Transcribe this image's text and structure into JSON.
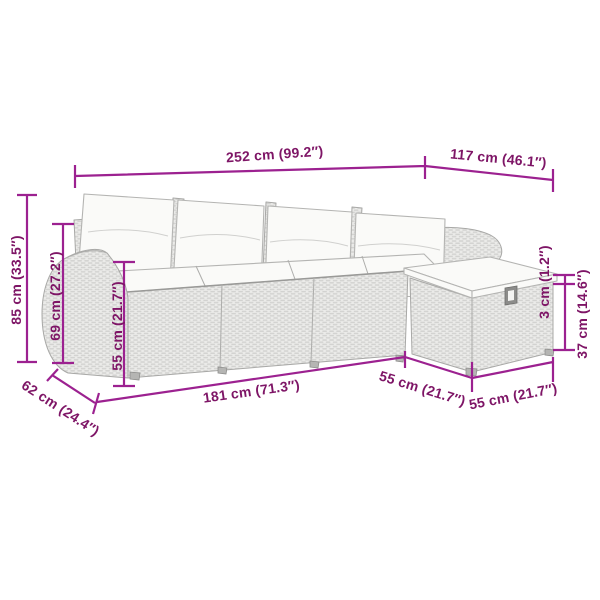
{
  "illustration": {
    "alt": "Light gray poly rattan garden sofa set with white cushions: four-seat sofa with armrests and an angled footstool module, annotated with dimension lines"
  },
  "colors": {
    "background": "#ffffff",
    "dimension_line": "#9c2190",
    "dimension_text": "#7e1566",
    "furniture_outline": "#a8a8a6",
    "wicker_fill": "#ebebe9",
    "wicker_weave": "#d2d2d0",
    "cushion_fill": "#fafaf8"
  },
  "dimensions": {
    "overall_width": "252 cm (99.2″)",
    "chaise_width": "117 cm (46.1″)",
    "overall_height": "85 cm (33.5″)",
    "armrest_height": "69 cm (27.2″)",
    "seat_height": "55 cm (21.7″)",
    "seat_depth": "62 cm (24.4″)",
    "sofa_front_width": "181 cm (71.3″)",
    "corner_module_width": "55 cm (21.7″)",
    "footstool_width": "55 cm (21.7″)",
    "cushion_thickness": "3 cm (1.2″)",
    "footstool_height": "37 cm (14.6″)"
  }
}
